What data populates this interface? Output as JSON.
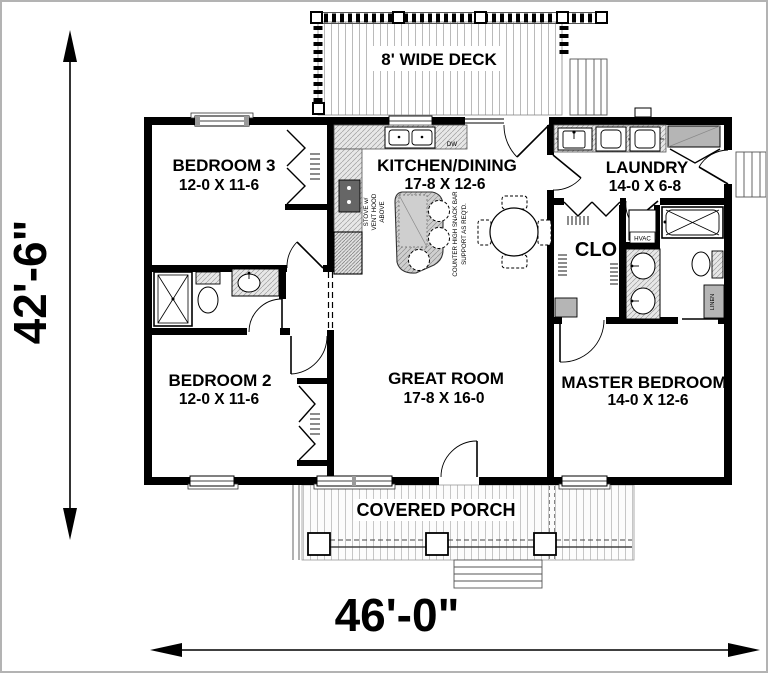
{
  "title": "House floor plan",
  "dimensions": {
    "overall_width": "46'-0\"",
    "overall_height": "42'-6\""
  },
  "deck": {
    "label": "8' WIDE DECK"
  },
  "porch": {
    "label": "COVERED PORCH"
  },
  "rooms": {
    "bedroom3": {
      "name": "BEDROOM 3",
      "size": "12-0 X 11-6"
    },
    "kitchen": {
      "name": "KITCHEN/DINING",
      "size": "17-8 X 12-6"
    },
    "laundry": {
      "name": "LAUNDRY",
      "size": "14-0 X 6-8"
    },
    "bedroom2": {
      "name": "BEDROOM 2",
      "size": "12-0 X 11-6"
    },
    "great_room": {
      "name": "GREAT ROOM",
      "size": "17-8 X 16-0"
    },
    "master": {
      "name": "MASTER BEDROOM",
      "size": "14-0 X 12-6"
    },
    "closet": {
      "label": "CLO"
    }
  },
  "annotations": {
    "stove_line1": "STOVE w/",
    "stove_line2": "VENT HOOD",
    "stove_line3": "ABOVE",
    "snack_line1": "COUNTER HIGH SNACK BAR",
    "snack_line2": "SUPPORT AS REQ'D.",
    "dishwasher": "DW",
    "hvac": "HVAC",
    "linen": "LINEN"
  },
  "colors": {
    "wall": "#000000",
    "counter": "#e4e4e4",
    "island": "#cbcbcb",
    "shelf": "#b5b5b5",
    "background": "#ffffff"
  }
}
